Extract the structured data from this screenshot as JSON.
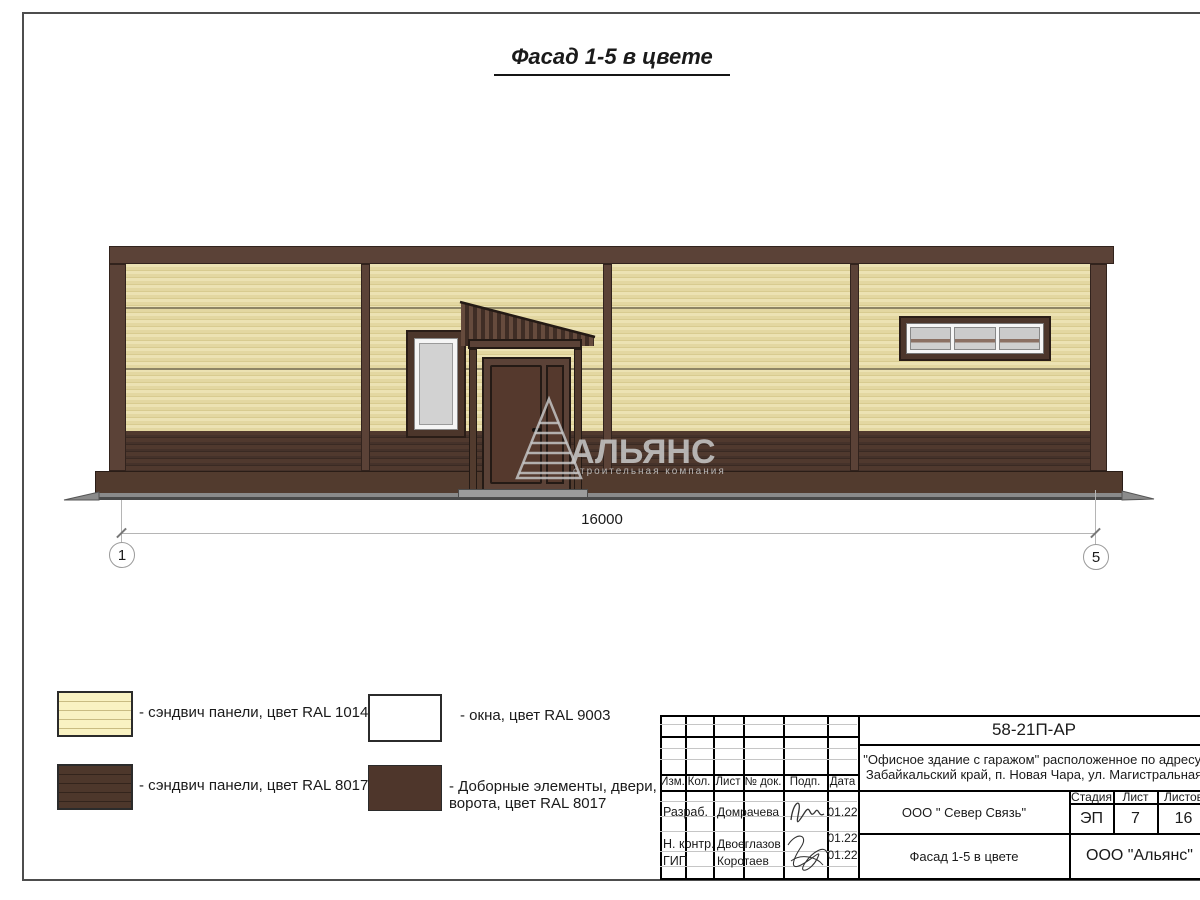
{
  "sheet": {
    "title": "Фасад 1-5 в цвете"
  },
  "facade": {
    "dimension_label": "16000",
    "axis_left": "1",
    "axis_right": "5",
    "watermark": {
      "name": "АЛЬЯНС",
      "tagline": "строительная компания"
    }
  },
  "legend": {
    "items": [
      {
        "swatch": "sandwich-panels-ral1014",
        "label": "- сэндвич панели, цвет RAL 1014"
      },
      {
        "swatch": "sandwich-panels-ral8017",
        "label": "- сэндвич панели, цвет RAL 8017"
      },
      {
        "swatch": "windows-ral9003",
        "label": "- окна, цвет RAL 9003"
      },
      {
        "swatch": "doors-gates-ral8017",
        "label_line1": "- Доборные элементы, двери,",
        "label_line2": "ворота, цвет RAL 8017"
      }
    ]
  },
  "title_block": {
    "doc_number": "58-21П-АР",
    "project_line1": "\"Офисное здание с гаражом\" расположенное по адресу:",
    "project_line2": "Забайкальский край, п. Новая Чара, ул. Магистральная",
    "rev_headers": {
      "izm": "Изм.",
      "kol": "Кол.",
      "list": "Лист",
      "doc": "№ док.",
      "podp": "Подп.",
      "data": "Дата"
    },
    "signature_rows": [
      {
        "role": "Разраб.",
        "name": "Домрачева",
        "date": "01.22"
      },
      {
        "role": "Н. контр.",
        "name": "Двоеглазов",
        "date": "01.22"
      },
      {
        "role": "ГИП",
        "name": "Коротаев",
        "date": "01.22"
      }
    ],
    "contractor": "ООО \" Север Связь\"",
    "sheet_name": "Фасад 1-5 в цвете",
    "company": "ООО \"Альянс\"",
    "stage_header": "Стадия",
    "stage_value": "ЭП",
    "sheet_header": "Лист",
    "sheet_value": "7",
    "sheets_header": "Листов",
    "sheets_value": "16"
  },
  "colors": {
    "panel_ral1014": "#e4d9a4",
    "panel_ral8017": "#4e372c",
    "windows_ral9003": "#ffffff",
    "trim_brown": "#5b4237",
    "glass": "#d2d2d2",
    "ground": "#8a8a8a",
    "watermark_gray": "#c5c5c5"
  }
}
